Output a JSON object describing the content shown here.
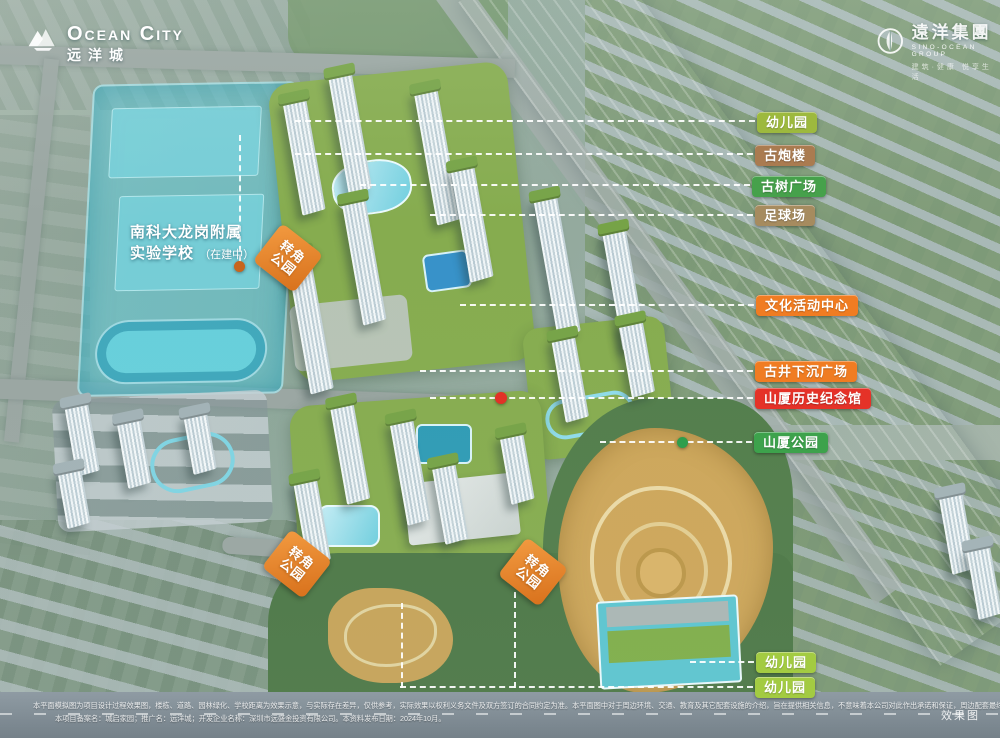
{
  "branding": {
    "ocean_city": {
      "name_en": "Ocean City",
      "name_cn": "远洋城"
    },
    "sino_ocean": {
      "name_cn": "遠洋集團",
      "name_en": "SINO-OCEAN GROUP",
      "tagline": "建筑·健康 悦享生活"
    }
  },
  "school_label": {
    "line1": "南科大龙岗附属",
    "line2": "实验学校",
    "status": "（在建中）"
  },
  "corner_park": {
    "line1": "转角",
    "line2": "公园"
  },
  "callouts": [
    {
      "id": "kindergarten-1",
      "label": "幼儿园",
      "color": "#9db93e"
    },
    {
      "id": "ancient-gun-tower",
      "label": "古炮楼",
      "color": "#aa7b50"
    },
    {
      "id": "ancient-tree-plaza",
      "label": "古树广场",
      "color": "#46a14b"
    },
    {
      "id": "football-field",
      "label": "足球场",
      "color": "#a68b5f"
    },
    {
      "id": "cultural-center",
      "label": "文化活动中心",
      "color": "#f07c22"
    },
    {
      "id": "ancient-well-plaza",
      "label": "古井下沉广场",
      "color": "#f07c22"
    },
    {
      "id": "shanxia-memorial-hall",
      "label": "山厦历史纪念馆",
      "color": "#e53228"
    },
    {
      "id": "shanxia-park",
      "label": "山厦公园",
      "color": "#3da24c"
    },
    {
      "id": "kindergarten-2",
      "label": "幼儿园",
      "color": "#a3cb42"
    },
    {
      "id": "kindergarten-3",
      "label": "幼儿园",
      "color": "#a3cb42"
    }
  ],
  "markers": {
    "school_dot_color": "#c8651d",
    "memorial_dot_color": "#e23127",
    "park_dot_color": "#2e9e4c"
  },
  "watermark": "效果图",
  "disclaimer": {
    "line1": "本平面模拟图为项目设计过程效果图，楼栋、道路、园林绿化、学校距离为效果示意，与实际存在差异，仅供参考，实际效果以权利义务文件及双方签订的合同约定为准。本平面图中对于周边环境、交通、教育及其它配套设施的介绍，旨在提供相关信息，不意味着本公司对此作出承诺和保证，周边配套最终以政府和有关部门公示的信息为准。",
    "line2": "本项目备案名：城启家园；推广名：远洋城；开发企业名称：深圳市远盛金投资有限公司。本资料发布日期：2024年10月。"
  }
}
